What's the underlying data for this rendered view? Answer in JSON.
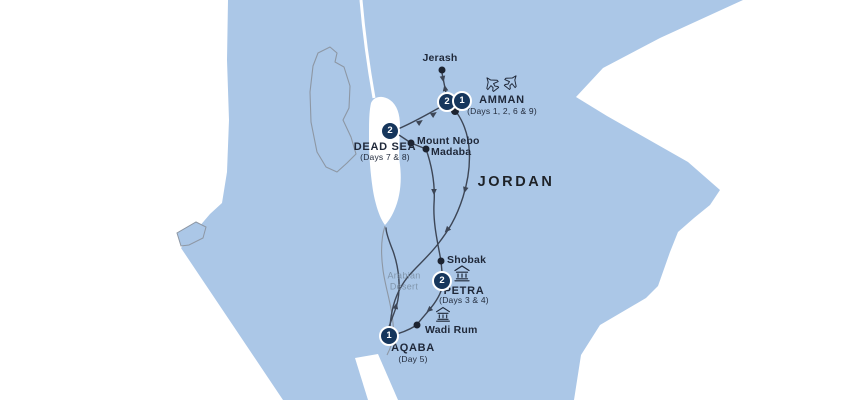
{
  "palette": {
    "sea": "#ffffff",
    "land": "#abc7e7",
    "border_line": "#8d97a4",
    "route_line": "#3d4656",
    "marker_bg": "#16365c",
    "marker_text": "#ffffff",
    "label_text": "#1f2839",
    "desert_text": "#8095ab"
  },
  "country": {
    "label": "JORDAN"
  },
  "region": {
    "desert_line1": "Arabian",
    "desert_line2": "Desert"
  },
  "icons": {
    "amman_flights": "flight-icon",
    "petra_site": "historic-site-icon",
    "wadi_rum_site": "historic-site-icon"
  },
  "stops": {
    "jerash": {
      "label": "Jerash"
    },
    "amman": {
      "label": "AMMAN",
      "days": "(Days 1, 2, 6 & 9)",
      "marker_a": "2",
      "marker_b": "1"
    },
    "dead_sea": {
      "label": "DEAD SEA",
      "days": "(Days 7 & 8)",
      "marker": "2"
    },
    "mount_nebo": {
      "label": "Mount Nebo"
    },
    "madaba": {
      "label": "Madaba"
    },
    "shobak": {
      "label": "Shobak"
    },
    "petra": {
      "label": "PETRA",
      "days": "(Days 3 & 4)",
      "marker": "2"
    },
    "wadi_rum": {
      "label": "Wadi Rum"
    },
    "aqaba": {
      "label": "AQABA",
      "days": "(Day 5)",
      "marker": "1"
    }
  }
}
